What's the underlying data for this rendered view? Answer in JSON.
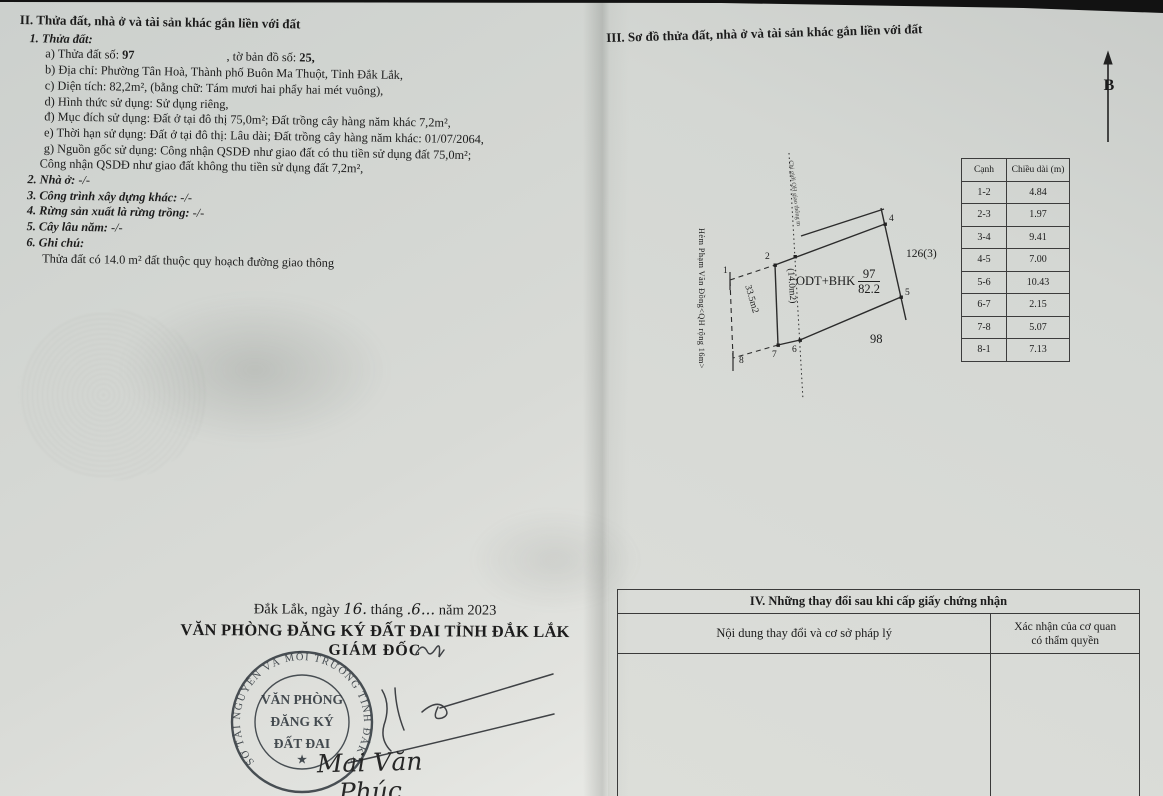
{
  "left": {
    "section_title": "II. Thửa đất, nhà ở và tài sản khác gắn liền với đất",
    "parcel_heading": "1. Thửa đất:",
    "a_label": "a) Thửa đất số:",
    "a_value": "97",
    "a_mid": ", tờ bản đồ số:",
    "a_value2": "25,",
    "b": "b) Địa chỉ: Phường Tân Hoà, Thành phố Buôn Ma Thuột, Tỉnh Đắk Lắk,",
    "c": "c) Diện tích: 82,2m², (bằng chữ: Tám mươi hai phẩy hai mét vuông),",
    "d": "d) Hình thức sử dụng: Sử dụng riêng,",
    "dd": "đ) Mục đích sử dụng: Đất ở tại đô thị 75,0m²; Đất trồng cây hàng năm khác 7,2m²,",
    "e": "e) Thời hạn sử dụng: Đất ở tại đô thị: Lâu dài; Đất trồng cây hàng năm khác: 01/07/2064,",
    "g": "g) Nguồn gốc sử dụng: Công nhận QSDĐ như giao đất có thu tiền sử dụng đất 75,0m²;",
    "g_cont": "Công nhận QSDĐ như giao đất không thu tiền sử dụng đất 7,2m²,",
    "item2": "2. Nhà ở:",
    "item2_v": "-/-",
    "item3": "3. Công trình xây dựng khác:",
    "item3_v": "-/-",
    "item4": "4. Rừng sản xuất là rừng trồng:",
    "item4_v": "-/-",
    "item5": "5. Cây lâu năm:",
    "item5_v": "-/-",
    "item6": "6. Ghi chú:",
    "note": "Thửa đất có  14.0 m² đất thuộc quy hoạch đường giao thông"
  },
  "sign": {
    "date_pre": "Đắk Lắk, ngày",
    "date_day": "16.",
    "date_thang": "tháng",
    "date_month": ".6...",
    "date_post": "năm 2023",
    "office": "VĂN PHÒNG ĐĂNG KÝ ĐẤT ĐAI TỈNH ĐẮK LẮK",
    "role": "GIÁM ĐỐC",
    "signer": "Mai Văn Phúc",
    "seal_ring": "SỞ TÀI NGUYÊN VÀ MÔI TRƯỜNG TỈNH ĐẮK LẮK",
    "seal_line1": "VĂN PHÒNG",
    "seal_line2": "ĐĂNG KÝ",
    "seal_line3": "ĐẤT ĐAI",
    "seal_star": "★"
  },
  "right": {
    "section_title": "III. Sơ đồ thửa đất, nhà ở và tài sản khác gắn liền với đất",
    "north_label": "B",
    "diagram": {
      "usage_code": "ODT+BHK",
      "parcel_number": "97",
      "parcel_area": "82.2",
      "strip_area": "(14.0m2)",
      "alley_area": "33.5m2",
      "neighbor_right": "126(3)",
      "neighbor_bottom": "98",
      "alley_label": "Hẻm Phạm Văn Đồng<QH rộng 16m>",
      "planning_line_label": "Chỉ giới QH giao thông m",
      "p1": "1",
      "p2": "2",
      "p4": "4",
      "p5": "5",
      "p6": "6",
      "p7": "7",
      "p8": "8"
    },
    "edge_table": {
      "headers": [
        "Cạnh",
        "Chiều dài (m)"
      ],
      "rows": [
        [
          "1-2",
          "4.84"
        ],
        [
          "2-3",
          "1.97"
        ],
        [
          "3-4",
          "9.41"
        ],
        [
          "4-5",
          "7.00"
        ],
        [
          "5-6",
          "10.43"
        ],
        [
          "6-7",
          "2.15"
        ],
        [
          "7-8",
          "5.07"
        ],
        [
          "8-1",
          "7.13"
        ]
      ]
    },
    "section4": {
      "title": "IV. Những thay đổi sau khi cấp giấy chứng nhận",
      "col1": "Nội dung thay đổi và cơ sở pháp lý",
      "col2a": "Xác nhận của cơ quan",
      "col2b": "có thẩm quyền"
    }
  }
}
